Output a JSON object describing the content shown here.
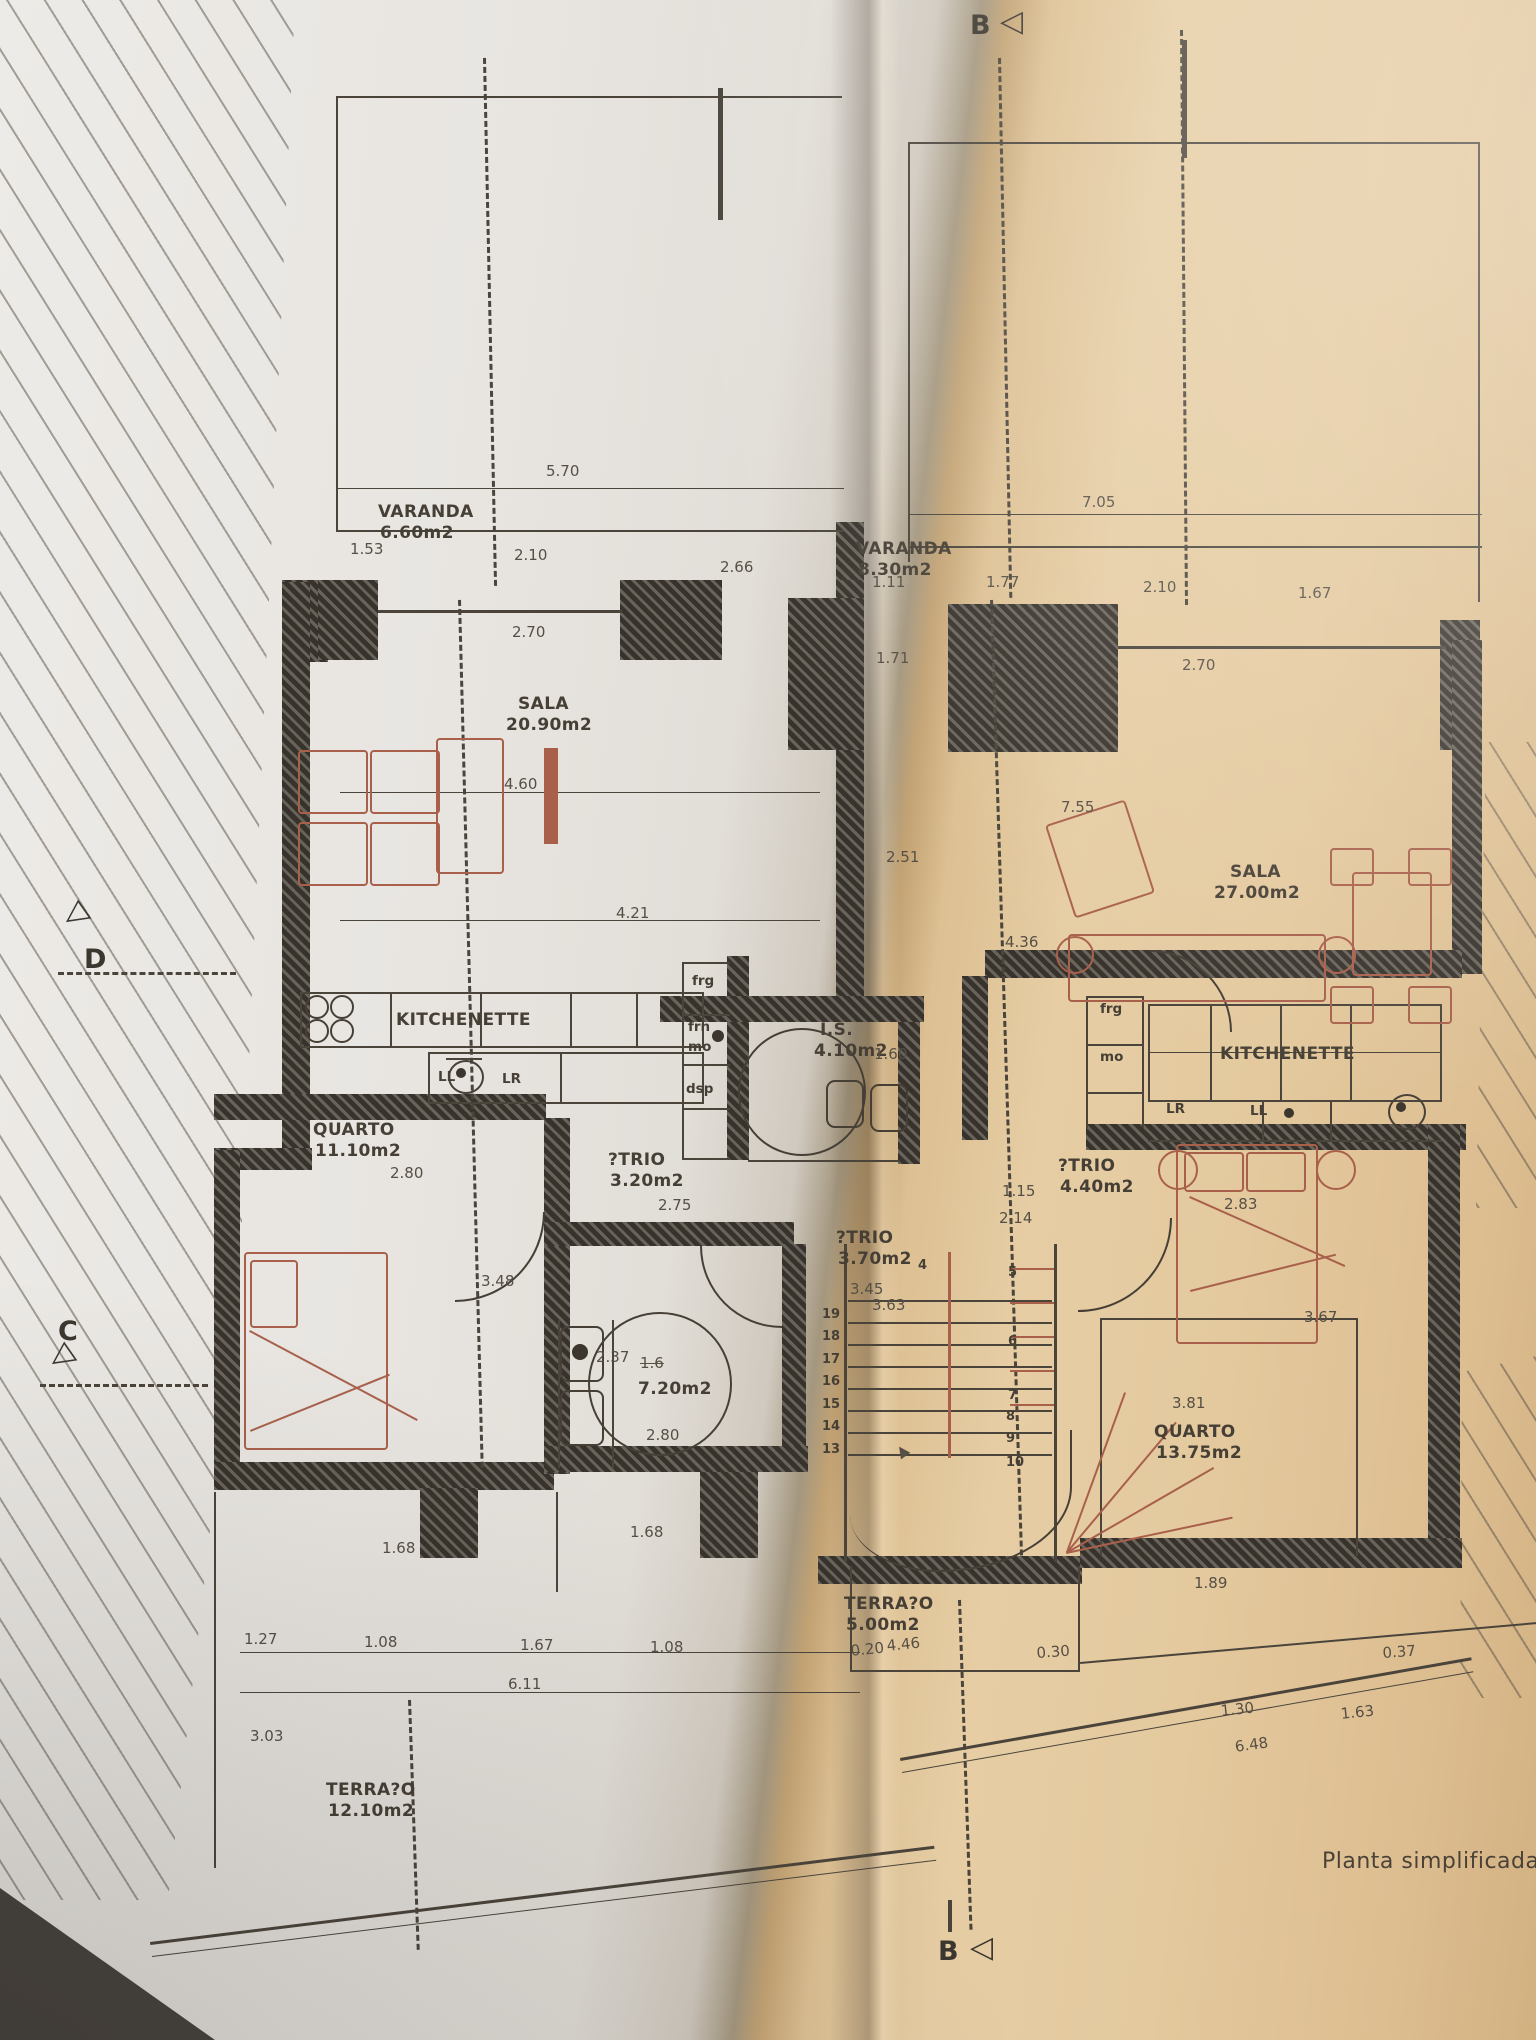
{
  "caption": {
    "t": "Planta simplificada d"
  },
  "markers": {
    "top": {
      "t": "B",
      "flag": "◁"
    },
    "bottom": {
      "t": "B",
      "flag": "◁"
    },
    "d": {
      "t": "D",
      "flag": "◁"
    },
    "c": {
      "t": "C",
      "flag": "◁"
    }
  },
  "rooms": [
    {
      "n": "VARANDA",
      "a": "6.60m2",
      "x": 378,
      "y": 504
    },
    {
      "n": "VARANDA",
      "a": "8.30m2",
      "x": 856,
      "y": 541
    },
    {
      "n": "SALA",
      "a": "20.90m2",
      "x": 518,
      "y": 696,
      "ax": 506
    },
    {
      "n": "SALA",
      "a": "27.00m2",
      "x": 1230,
      "y": 864,
      "ax": 1214
    },
    {
      "n": "KITCHENETTE",
      "a": "",
      "x": 396,
      "y": 1012
    },
    {
      "n": "KITCHENETTE",
      "a": "",
      "x": 1220,
      "y": 1046
    },
    {
      "n": "QUARTO",
      "a": "11.10m2",
      "x": 313,
      "y": 1122
    },
    {
      "n": "QUARTO",
      "a": "13.75m2",
      "x": 1154,
      "y": 1424
    },
    {
      "n": "?TRIO",
      "a": "3.20m2",
      "x": 608,
      "y": 1152
    },
    {
      "n": "?TRIO",
      "a": "3.70m2",
      "x": 836,
      "y": 1230
    },
    {
      "n": "?TRIO",
      "a": "4.40m2",
      "x": 1058,
      "y": 1158
    },
    {
      "n": "I.S.",
      "a": "4.10m2",
      "x": 820,
      "y": 1022,
      "ax": 814
    },
    {
      "n": "",
      "a": "7.20m2",
      "x": 636,
      "y": 1360
    },
    {
      "n": "TERRA?O",
      "a": "5.00m2",
      "x": 844,
      "y": 1596
    },
    {
      "n": "TERRA?O",
      "a": "12.10m2",
      "x": 326,
      "y": 1782
    }
  ],
  "appliances": [
    {
      "t": "frg",
      "x": 692,
      "y": 974
    },
    {
      "t": "frn",
      "x": 688,
      "y": 1020
    },
    {
      "t": "mo",
      "x": 688,
      "y": 1040
    },
    {
      "t": "dsp",
      "x": 686,
      "y": 1082
    },
    {
      "t": "LL",
      "x": 438,
      "y": 1070
    },
    {
      "t": "LR",
      "x": 502,
      "y": 1072
    },
    {
      "t": "frg",
      "x": 1100,
      "y": 1002
    },
    {
      "t": "mo",
      "x": 1100,
      "y": 1050
    },
    {
      "t": "LR",
      "x": 1166,
      "y": 1102
    },
    {
      "t": "LL",
      "x": 1250,
      "y": 1104
    }
  ],
  "dimensions": [
    {
      "t": "5.70",
      "x": 546,
      "y": 464
    },
    {
      "t": "1.53",
      "x": 350,
      "y": 542
    },
    {
      "t": "2.10",
      "x": 514,
      "y": 548
    },
    {
      "t": "2.66",
      "x": 720,
      "y": 560
    },
    {
      "t": "2.70",
      "x": 512,
      "y": 625
    },
    {
      "t": "7.05",
      "x": 1082,
      "y": 495
    },
    {
      "t": "1.11",
      "x": 872,
      "y": 575
    },
    {
      "t": "1.77",
      "x": 986,
      "y": 575
    },
    {
      "t": "2.10",
      "x": 1143,
      "y": 580
    },
    {
      "t": "1.67",
      "x": 1298,
      "y": 586
    },
    {
      "t": "1.71",
      "x": 876,
      "y": 651
    },
    {
      "t": "2.70",
      "x": 1182,
      "y": 658
    },
    {
      "t": "4.60",
      "x": 504,
      "y": 777
    },
    {
      "t": "7.55",
      "x": 1061,
      "y": 800
    },
    {
      "t": "2.51",
      "x": 886,
      "y": 850
    },
    {
      "t": "4.21",
      "x": 616,
      "y": 906
    },
    {
      "t": "4.36",
      "x": 1005,
      "y": 935
    },
    {
      "t": "1.60",
      "x": 874,
      "y": 1047
    },
    {
      "t": "2.80",
      "x": 390,
      "y": 1166
    },
    {
      "t": "2.75",
      "x": 658,
      "y": 1198
    },
    {
      "t": "1.15",
      "x": 1002,
      "y": 1184
    },
    {
      "t": "2.14",
      "x": 999,
      "y": 1211
    },
    {
      "t": "2.83",
      "x": 1224,
      "y": 1197
    },
    {
      "t": "3.48",
      "x": 481,
      "y": 1274
    },
    {
      "t": "3.45",
      "x": 850,
      "y": 1282
    },
    {
      "t": "3.63",
      "x": 872,
      "y": 1298
    },
    {
      "t": "2.37",
      "x": 596,
      "y": 1350
    },
    {
      "t": "1.6",
      "x": 640,
      "y": 1356,
      "s": true
    },
    {
      "t": "2.80",
      "x": 646,
      "y": 1428
    },
    {
      "t": "3.67",
      "x": 1304,
      "y": 1310
    },
    {
      "t": "3.81",
      "x": 1172,
      "y": 1396
    },
    {
      "t": "1.68",
      "x": 382,
      "y": 1541
    },
    {
      "t": "1.68",
      "x": 630,
      "y": 1525
    },
    {
      "t": "1.89",
      "x": 1194,
      "y": 1576
    },
    {
      "t": "1.27",
      "x": 244,
      "y": 1632
    },
    {
      "t": "1.08",
      "x": 364,
      "y": 1635
    },
    {
      "t": "1.67",
      "x": 520,
      "y": 1638
    },
    {
      "t": "1.08",
      "x": 650,
      "y": 1640
    },
    {
      "t": "6.11",
      "x": 508,
      "y": 1677
    },
    {
      "t": "0.20",
      "x": 850,
      "y": 1644,
      "r": -6
    },
    {
      "t": "4.46",
      "x": 886,
      "y": 1639,
      "r": -6
    },
    {
      "t": "0.30",
      "x": 1036,
      "y": 1646,
      "r": -4
    },
    {
      "t": "0.37",
      "x": 1382,
      "y": 1646,
      "r": -4
    },
    {
      "t": "1.30",
      "x": 1220,
      "y": 1704,
      "r": -6
    },
    {
      "t": "1.63",
      "x": 1340,
      "y": 1707,
      "r": -6
    },
    {
      "t": "6.48",
      "x": 1234,
      "y": 1740,
      "r": -8
    },
    {
      "t": "3.03",
      "x": 250,
      "y": 1729
    }
  ],
  "stairs": {
    "left": [
      {
        "t": "19",
        "x": 822,
        "y": 1308
      },
      {
        "t": "18",
        "x": 822,
        "y": 1330
      },
      {
        "t": "17",
        "x": 822,
        "y": 1353
      },
      {
        "t": "16",
        "x": 822,
        "y": 1375
      },
      {
        "t": "15",
        "x": 822,
        "y": 1398
      },
      {
        "t": "14",
        "x": 822,
        "y": 1420
      },
      {
        "t": "13",
        "x": 822,
        "y": 1443
      }
    ],
    "right": [
      {
        "t": "4",
        "x": 918,
        "y": 1259
      },
      {
        "t": "5",
        "x": 1008,
        "y": 1266
      },
      {
        "t": "6",
        "x": 1008,
        "y": 1335
      },
      {
        "t": "7",
        "x": 1008,
        "y": 1389
      },
      {
        "t": "8",
        "x": 1006,
        "y": 1410
      },
      {
        "t": "9",
        "x": 1006,
        "y": 1432
      },
      {
        "t": "10",
        "x": 1006,
        "y": 1456
      }
    ]
  }
}
